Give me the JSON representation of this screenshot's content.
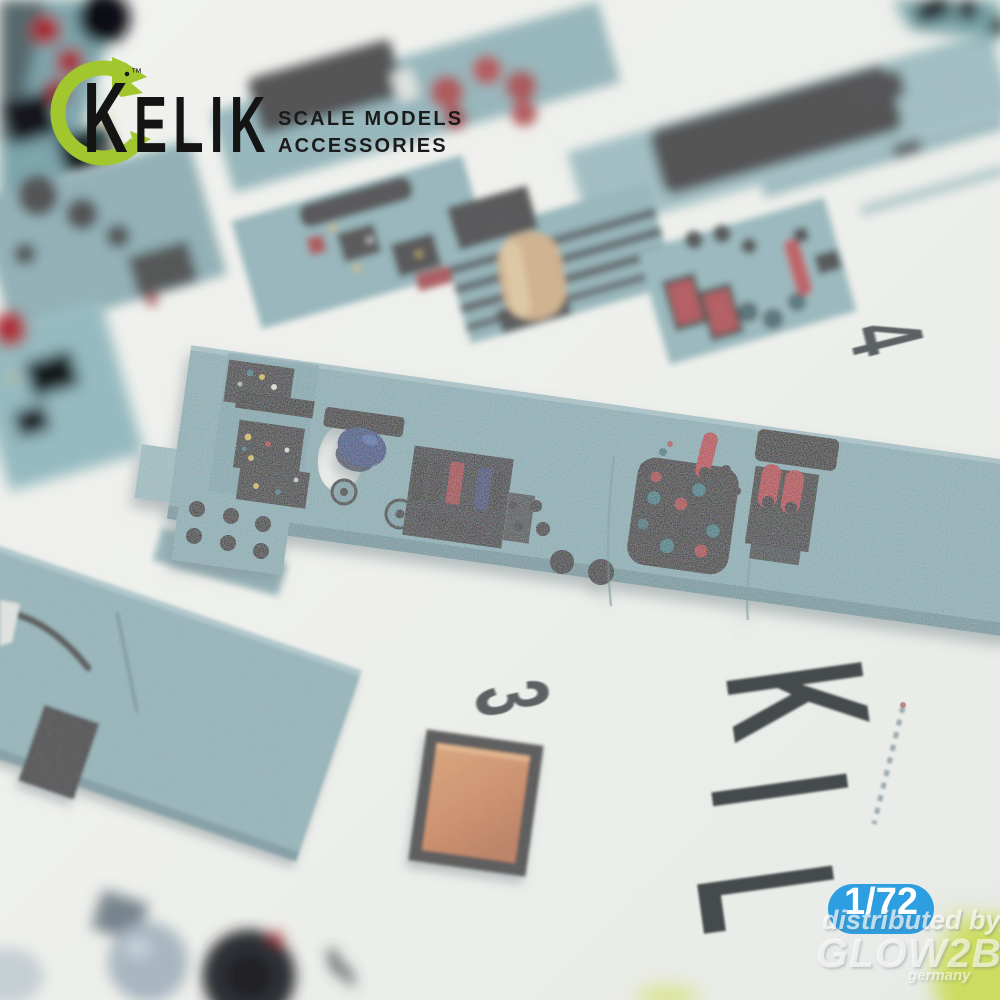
{
  "branding": {
    "logo_initial": "K",
    "logo_rest": "ELIK",
    "trademark": "™",
    "tagline_line1": "SCALE MODELS",
    "tagline_line2": "ACCESSORIES"
  },
  "sheet_markings": {
    "part_number_4": "4",
    "part_number_3": "3",
    "embossed_letters": {
      "letter_1": "K",
      "letter_2": "I",
      "letter_3": "L"
    }
  },
  "overlay": {
    "scale_badge": "1/72",
    "watermark_line1": "distributed by",
    "watermark_line2": "GLOW2B",
    "watermark_line3": "germany"
  },
  "palette": {
    "paper": "#edefeb",
    "panel_teal": "#8bb2b9",
    "panel_teal_light": "#9fc2c7",
    "logo_green": "#a2c62e",
    "ink_black": "#141414",
    "component_red": "#b23038",
    "component_dark": "#1b1e21",
    "badge_blue": "#2d9fe0",
    "accent_orange": "#d3874e",
    "accent_beige": "#dcc094",
    "number_gray": "#4e5357",
    "letter_gray": "#383c3f"
  }
}
